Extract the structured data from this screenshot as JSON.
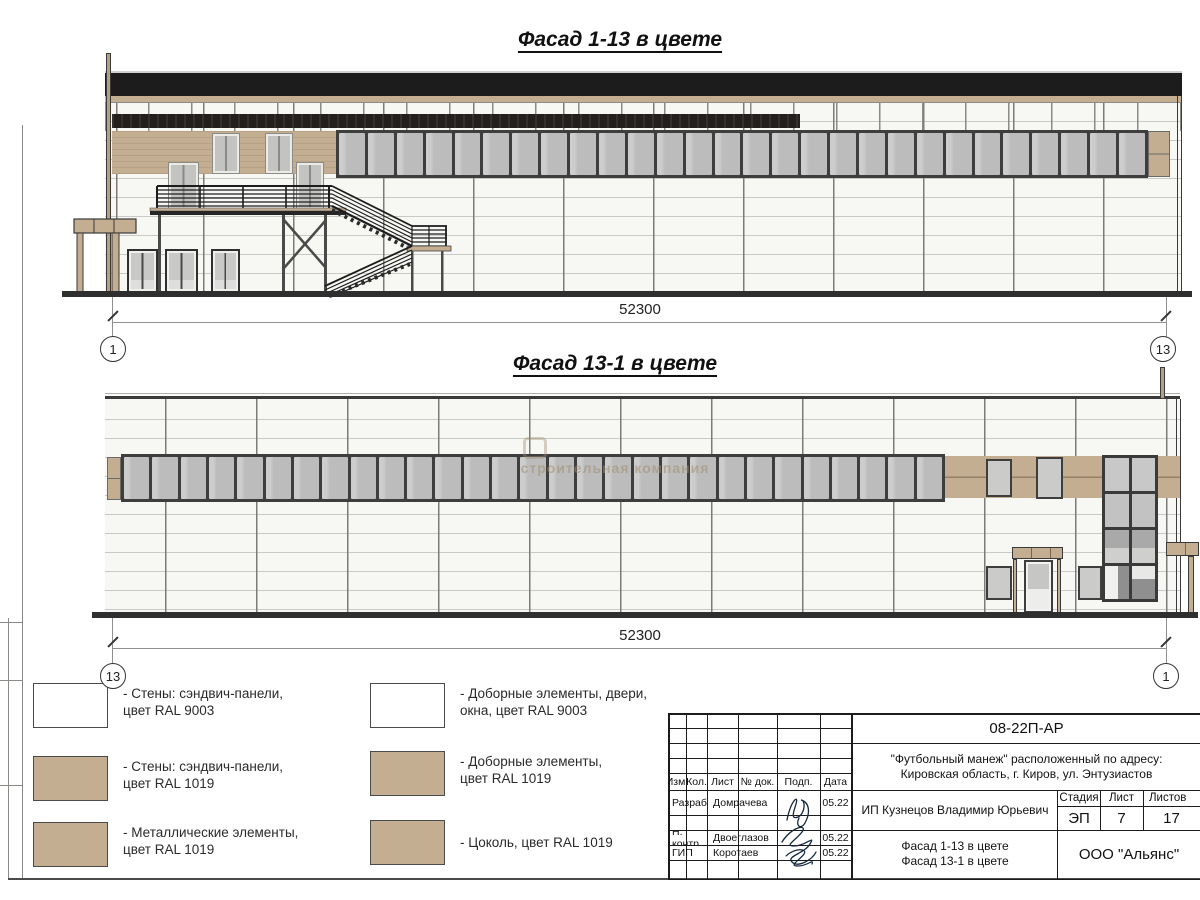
{
  "watermark": {
    "text": "строительная компания"
  },
  "facade1": {
    "title": "Фасад 1-13 в цвете",
    "dimension": "52300",
    "grid_bubble_left": "1",
    "grid_bubble_right": "13",
    "ribbon_pane_count": 28
  },
  "facade2": {
    "title": "Фасад 13-1 в цвете",
    "dimension": "52300",
    "grid_bubble_left": "13",
    "grid_bubble_right": "1",
    "ribbon_pane_count": 29,
    "curtain_cell_count": 8
  },
  "legend": {
    "items": [
      {
        "swatch": "white",
        "line1": "- Стены: сэндвич-панели,",
        "line2": "цвет RAL 9003"
      },
      {
        "swatch": "tan",
        "line1": "- Стены: сэндвич-панели,",
        "line2": "цвет RAL 1019"
      },
      {
        "swatch": "tan",
        "line1": "- Металлические элементы,",
        "line2": "цвет RAL 1019"
      },
      {
        "swatch": "white",
        "line1": "- Доборные элементы, двери,",
        "line2": "окна, цвет RAL 9003"
      },
      {
        "swatch": "tan",
        "line1": "- Доборные элементы,",
        "line2": "цвет RAL 1019"
      },
      {
        "swatch": "tan",
        "line1": "- Цоколь, цвет RAL 1019",
        "line2": ""
      }
    ]
  },
  "title_block": {
    "doc_code": "08-22П-АР",
    "project_line1": "\"Футбольный манеж\" расположенный по адресу:",
    "project_line2": "Кировская область, г. Киров, ул. Энтузиастов",
    "columns": [
      "Изм.",
      "Кол.",
      "Лист",
      "№ док.",
      "Подп.",
      "Дата"
    ],
    "rows": [
      {
        "role": "Разраб.",
        "name": "Домрачева",
        "date": "05.22"
      },
      {
        "role": "Н. контр.",
        "name": "Двоеглазов",
        "date": "05.22"
      },
      {
        "role": "ГИП",
        "name": "Коротаев",
        "date": "05.22"
      }
    ],
    "client": "ИП Кузнецов Владимир Юрьевич",
    "stage_label": "Стадия",
    "sheet_label": "Лист",
    "sheets_label": "Листов",
    "stage": "ЭП",
    "sheet": "7",
    "sheets": "17",
    "sheet_title_line1": "Фасад 1-13 в цвете",
    "sheet_title_line2": "Фасад 13-1 в цвете",
    "org": "ООО \"Альянс\""
  },
  "colors": {
    "tan_ral1019": "#c3ae92",
    "white_ral9003": "#f6f6f3",
    "roof_band": "#1c1c1c",
    "window_glass": "#bcbcbc",
    "window_frame": "#3e3e3e"
  }
}
